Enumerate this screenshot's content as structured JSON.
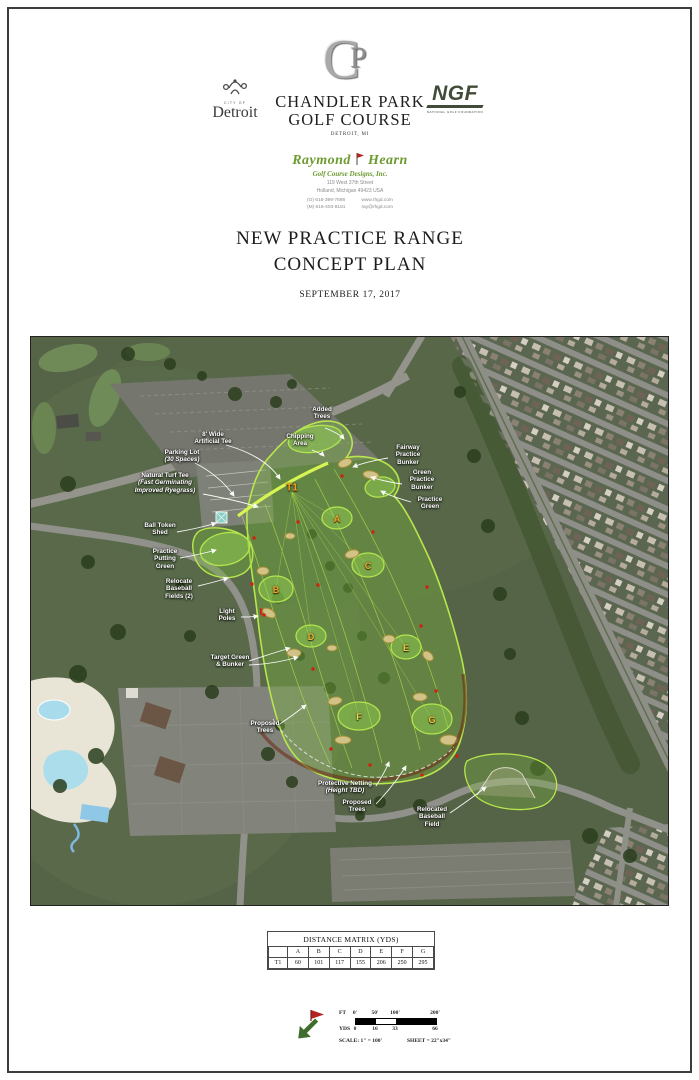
{
  "header": {
    "detroit_logo": {
      "city_of": "CITY OF",
      "name": "Detroit"
    },
    "monogram": {
      "c": "C",
      "p": "P"
    },
    "course_title_line1": "CHANDLER PARK",
    "course_title_line2": "GOLF COURSE",
    "course_subtitle": "DETROIT, MI",
    "ngf": {
      "acronym": "NGF",
      "tagline": "NATIONAL GOLF FOUNDATION"
    }
  },
  "designer": {
    "name_first": "Raymond",
    "name_last": "Hearn",
    "firm": "Golf Course Designs, Inc.",
    "address_line1": "119 West 37th Street",
    "address_line2": "Holland, Michigan 49423 USA",
    "phone_office": "(O) 616-399-7686",
    "phone_mobile": "(M) 616-403-8181",
    "website": "www.rhgd.com",
    "email": "ray@rhgd.com"
  },
  "title_block": {
    "line1": "NEW PRACTICE RANGE",
    "line2": "CONCEPT PLAN",
    "date": "SEPTEMBER 17, 2017"
  },
  "map": {
    "markers": [
      {
        "id": "T1",
        "label": "T1",
        "x": 262,
        "y": 152,
        "color": "#f6a31f",
        "size": 10
      },
      {
        "id": "A",
        "label": "A",
        "x": 307,
        "y": 183,
        "color": "#f0a42c",
        "size": 9
      },
      {
        "id": "B",
        "label": "B",
        "x": 246,
        "y": 254,
        "color": "#f0a42c",
        "size": 9
      },
      {
        "id": "C",
        "label": "C",
        "x": 338,
        "y": 230,
        "color": "#f0a42c",
        "size": 9
      },
      {
        "id": "D",
        "label": "D",
        "x": 281,
        "y": 301,
        "color": "#eeb637",
        "size": 9
      },
      {
        "id": "E",
        "label": "E",
        "x": 376,
        "y": 312,
        "color": "#e9cf46",
        "size": 9
      },
      {
        "id": "F",
        "label": "F",
        "x": 329,
        "y": 381,
        "color": "#e9d84e",
        "size": 9
      },
      {
        "id": "G",
        "label": "G",
        "x": 402,
        "y": 384,
        "color": "#ecc53b",
        "size": 9
      }
    ],
    "labels": [
      {
        "id": "added-trees",
        "x": 292,
        "y": 70,
        "lines": [
          {
            "text": "Added"
          },
          {
            "text": "Trees"
          }
        ]
      },
      {
        "id": "chipping-area",
        "x": 270,
        "y": 97,
        "lines": [
          {
            "text": "Chipping"
          },
          {
            "text": "Area"
          }
        ]
      },
      {
        "id": "artificial-tee",
        "x": 183,
        "y": 95,
        "lines": [
          {
            "text": "8' Wide"
          },
          {
            "text": "Artificial Tee"
          }
        ]
      },
      {
        "id": "parking-lot",
        "x": 152,
        "y": 113,
        "lines": [
          {
            "text": "Parking Lot"
          },
          {
            "text": "(30 Spaces)",
            "italic": true
          }
        ]
      },
      {
        "id": "fairway-practice-bunker",
        "x": 378,
        "y": 108,
        "lines": [
          {
            "text": "Fairway"
          },
          {
            "text": "Practice"
          },
          {
            "text": "Bunker"
          }
        ]
      },
      {
        "id": "green-practice-bunker",
        "x": 392,
        "y": 133,
        "lines": [
          {
            "text": "Green"
          },
          {
            "text": "Practice"
          },
          {
            "text": "Bunker"
          }
        ]
      },
      {
        "id": "practice-green",
        "x": 400,
        "y": 160,
        "lines": [
          {
            "text": "Practice"
          },
          {
            "text": "Green"
          }
        ]
      },
      {
        "id": "natural-turf-tee",
        "x": 135,
        "y": 136,
        "lines": [
          {
            "text": "Natural Turf Tee"
          },
          {
            "text": "(Fast Germinating",
            "italic": true
          },
          {
            "text": "Improved Ryegrass)",
            "italic": true
          }
        ]
      },
      {
        "id": "ball-token-shed",
        "x": 130,
        "y": 186,
        "lines": [
          {
            "text": "Ball Token"
          },
          {
            "text": "Shed"
          }
        ]
      },
      {
        "id": "practice-putting-green",
        "x": 135,
        "y": 212,
        "lines": [
          {
            "text": "Practice"
          },
          {
            "text": "Putting"
          },
          {
            "text": "Green"
          }
        ]
      },
      {
        "id": "relocate-baseball-fields",
        "x": 149,
        "y": 242,
        "lines": [
          {
            "text": "Relocate"
          },
          {
            "text": "Baseball"
          },
          {
            "text": "Fields (2)"
          }
        ]
      },
      {
        "id": "light-poles",
        "x": 197,
        "y": 272,
        "lines": [
          {
            "text": "Light"
          },
          {
            "text": "Poles"
          }
        ]
      },
      {
        "id": "target-green-bunker",
        "x": 200,
        "y": 318,
        "lines": [
          {
            "text": "Target Green"
          },
          {
            "text": "& Bunker"
          }
        ]
      },
      {
        "id": "proposed-trees-west",
        "x": 235,
        "y": 384,
        "lines": [
          {
            "text": "Proposed"
          },
          {
            "text": "Trees"
          }
        ]
      },
      {
        "id": "protective-netting",
        "x": 315,
        "y": 444,
        "lines": [
          {
            "text": "Protective Netting"
          },
          {
            "text": "(Height TBD)",
            "italic": true
          }
        ]
      },
      {
        "id": "proposed-trees-south",
        "x": 327,
        "y": 463,
        "lines": [
          {
            "text": "Proposed"
          },
          {
            "text": "Trees"
          }
        ]
      },
      {
        "id": "relocated-baseball-field",
        "x": 402,
        "y": 470,
        "lines": [
          {
            "text": "Relocated"
          },
          {
            "text": "Baseball"
          },
          {
            "text": "Field"
          }
        ]
      }
    ]
  },
  "distance_matrix": {
    "title": "DISTANCE MATRIX (YDS)",
    "columns": [
      "A",
      "B",
      "C",
      "D",
      "E",
      "F",
      "G"
    ],
    "rows": [
      {
        "label": "T1",
        "values": [
          "60",
          "101",
          "117",
          "155",
          "206",
          "250",
          "295"
        ]
      }
    ]
  },
  "scale_block": {
    "ft_label": "FT",
    "ft_ticks": [
      "0'",
      "50'",
      "100'",
      "200'"
    ],
    "yds_label": "YDS",
    "yds_ticks": [
      "0",
      "16",
      "33",
      "66"
    ],
    "scale_text": "SCALE: 1\" = 100'",
    "sheet_text": "SHEET = 22\"x34\""
  },
  "colors": {
    "range_outline": "#b8e64d",
    "marker_orange": "#f0a42c",
    "berm": "#6e2d18",
    "red_dot": "#cf2312",
    "designer_green": "#6b9a2f",
    "ngf_green": "#414c38"
  }
}
